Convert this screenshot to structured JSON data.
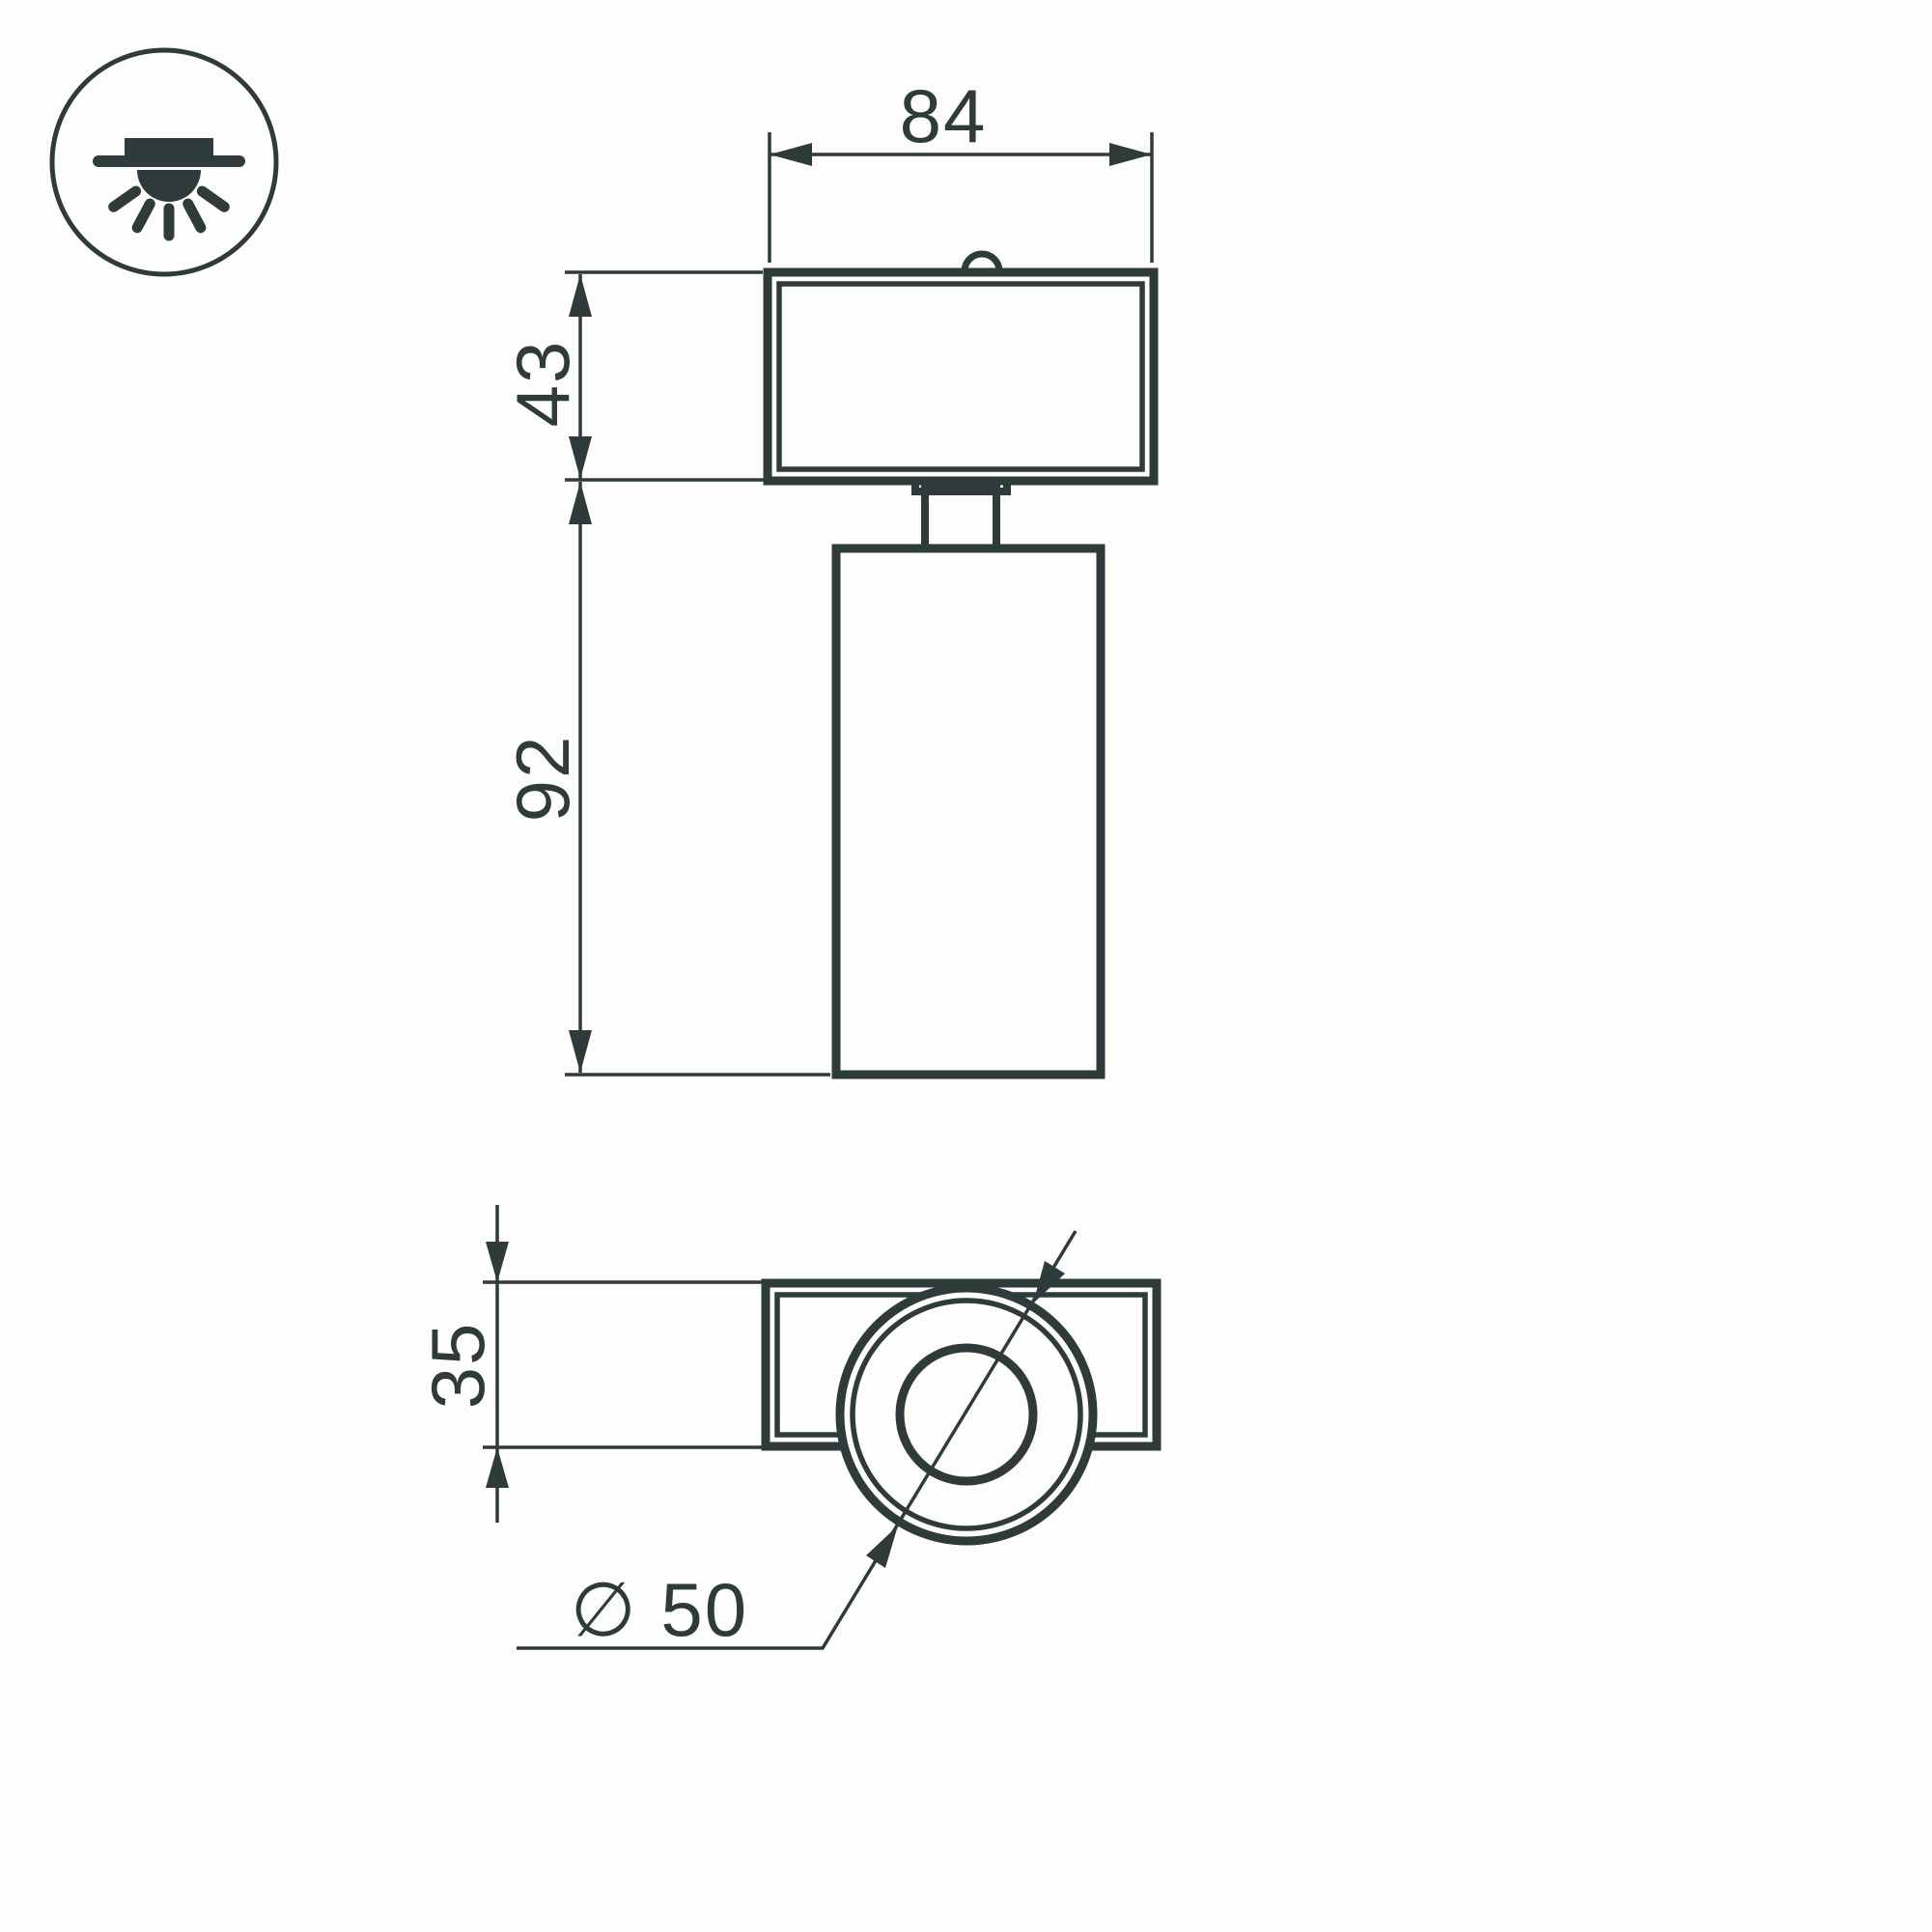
{
  "drawing": {
    "colors": {
      "line": "#2e3b3a",
      "bg": "#fdfdfc"
    },
    "icon": {
      "name": "surface-ceiling-mount-light-icon"
    },
    "front_view": {
      "dim_width": "84",
      "dim_mount_height": "43",
      "dim_body_height": "92"
    },
    "bottom_view": {
      "dim_bracket_depth": "35",
      "dim_diameter": "∅ 50"
    }
  }
}
